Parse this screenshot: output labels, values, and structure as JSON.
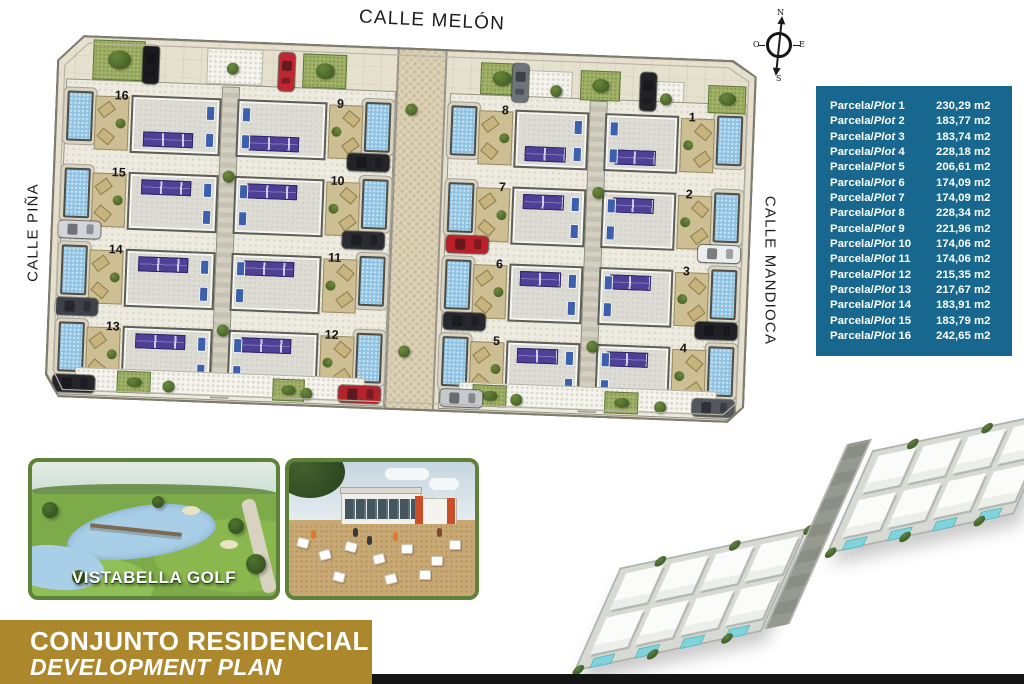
{
  "plan": {
    "streets": {
      "top": "CALLE MELÓN",
      "left": "CALLE PIÑA",
      "right": "CALLE MANDIOCA"
    },
    "compass": {
      "north": "N",
      "south": "S",
      "east": "E",
      "west": "O"
    },
    "blocks": [
      {
        "id": "west",
        "columns": {
          "A": [
            16,
            15,
            14,
            13
          ],
          "B": [
            9,
            10,
            11,
            12
          ]
        }
      },
      {
        "id": "east",
        "columns": {
          "A": [
            8,
            7,
            6,
            5
          ],
          "B": [
            1,
            2,
            3,
            4
          ]
        }
      }
    ],
    "cars": [
      {
        "x": 86,
        "y": 8,
        "v": 1,
        "c": "#1b1b1f"
      },
      {
        "x": 222,
        "y": 10,
        "v": 1,
        "c": "#bf2630"
      },
      {
        "x": 456,
        "y": 12,
        "v": 1,
        "c": "#6f737a"
      },
      {
        "x": 584,
        "y": 16,
        "v": 1,
        "c": "#232327"
      },
      {
        "x": 8,
        "y": 186,
        "v": 0,
        "c": "#d2d5d9"
      },
      {
        "x": 8,
        "y": 263,
        "v": 0,
        "c": "#3e4147"
      },
      {
        "x": 8,
        "y": 340,
        "v": 0,
        "c": "#24262a"
      },
      {
        "x": 648,
        "y": 186,
        "v": 0,
        "c": "#eceded"
      },
      {
        "x": 648,
        "y": 263,
        "v": 0,
        "c": "#1f2125"
      },
      {
        "x": 648,
        "y": 340,
        "v": 0,
        "c": "#54575d"
      },
      {
        "x": 294,
        "y": 108,
        "v": 0,
        "c": "#222428"
      },
      {
        "x": 292,
        "y": 186,
        "v": 0,
        "c": "#2a2c31"
      },
      {
        "x": 294,
        "y": 340,
        "v": 0,
        "c": "#b2232b"
      },
      {
        "x": 396,
        "y": 186,
        "v": 0,
        "c": "#bb2029"
      },
      {
        "x": 396,
        "y": 263,
        "v": 0,
        "c": "#26282d"
      },
      {
        "x": 396,
        "y": 340,
        "v": 0,
        "c": "#c7cacd"
      }
    ],
    "gardens": [
      [
        36,
        4,
        52,
        40
      ],
      [
        246,
        10,
        44,
        34
      ],
      [
        424,
        12,
        42,
        32
      ],
      [
        524,
        16,
        40,
        30
      ],
      [
        652,
        26,
        38,
        28
      ],
      [
        72,
        334,
        34,
        22
      ],
      [
        228,
        336,
        32,
        22
      ],
      [
        428,
        334,
        34,
        22
      ],
      [
        560,
        336,
        34,
        22
      ]
    ],
    "gravels": [
      [
        150,
        8,
        54,
        34
      ],
      [
        468,
        18,
        46,
        30
      ],
      [
        584,
        24,
        42,
        28
      ]
    ],
    "bushes": [
      [
        170,
        22
      ],
      [
        494,
        32
      ],
      [
        604,
        36
      ],
      [
        118,
        342
      ],
      [
        256,
        344
      ],
      [
        466,
        342
      ],
      [
        610,
        344
      ],
      [
        170,
        130
      ],
      [
        170,
        284
      ],
      [
        540,
        132
      ],
      [
        540,
        286
      ],
      [
        350,
        56
      ],
      [
        352,
        298
      ]
    ]
  },
  "table": {
    "label_prefix": "Parcela/",
    "label_word": "Plot",
    "unit": "m2",
    "rows": [
      {
        "plot": 1,
        "area": "230,29"
      },
      {
        "plot": 2,
        "area": "183,77"
      },
      {
        "plot": 3,
        "area": "183,74"
      },
      {
        "plot": 4,
        "area": "228,18"
      },
      {
        "plot": 5,
        "area": "206,61"
      },
      {
        "plot": 6,
        "area": "174,09"
      },
      {
        "plot": 7,
        "area": "174,09"
      },
      {
        "plot": 8,
        "area": "228,34"
      },
      {
        "plot": 9,
        "area": "221,96"
      },
      {
        "plot": 10,
        "area": "174,06"
      },
      {
        "plot": 11,
        "area": "174,06"
      },
      {
        "plot": 12,
        "area": "215,35"
      },
      {
        "plot": 13,
        "area": "217,67"
      },
      {
        "plot": 14,
        "area": "183,91"
      },
      {
        "plot": 15,
        "area": "183,79"
      },
      {
        "plot": 16,
        "area": "242,65"
      }
    ]
  },
  "photos": {
    "golf_caption": "VISTABELLA GOLF"
  },
  "render": {
    "blocks": 2,
    "villas_per_block": 8
  },
  "banner": {
    "line1": "CONJUNTO RESIDENCIAL",
    "line2": "DEVELOPMENT PLAN"
  },
  "colors": {
    "table_bg": "#17678e",
    "banner_bg": "#ac872b",
    "photo_border": "#5e8238",
    "solar_panel": "#4d4096",
    "pool": "#8ec2e2",
    "street_bg": "#e6e0ce"
  }
}
